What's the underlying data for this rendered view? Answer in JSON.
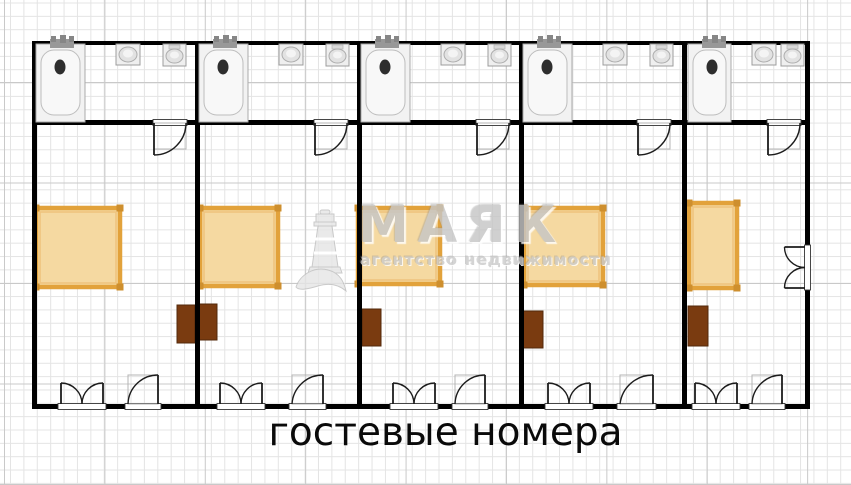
{
  "title": {
    "text": "гостевые номера"
  },
  "watermark": {
    "brand": "МАЯК",
    "tagline": "агентство недвижимости",
    "icon": "lighthouse-icon"
  },
  "colors": {
    "wall": "#000000",
    "door": "#1c1c1c",
    "door_frame": "#b5b5b5",
    "bed_fill": "#F5D9A1",
    "bed_border": "#E2A23B",
    "bed_inner": "#EFC27C",
    "bed_corner": "#CE8F2E",
    "nightstand_fill": "#7A3B10",
    "nightstand_stroke": "#53290B",
    "fixture_fill": "#efefef",
    "fixture_stroke": "#9c9c9c",
    "fixture_basin": "#e2e2e2",
    "tub_fill": "#f2f2f2",
    "faucet": "#989898",
    "drain": "#2e2e2e",
    "grid_minor": "#e4e4e4",
    "grid_major": "#c9c9c9",
    "watermark_gray": "#c6c6c6"
  },
  "plan": {
    "outline": {
      "x": 32,
      "y": 41,
      "w": 778,
      "h": 368,
      "wall_thickness": 5
    },
    "top_wall_y": 41,
    "divider_wall_y": 120,
    "bottom_wall_y": 404,
    "vertical_walls": [
      32,
      195,
      357,
      519,
      682,
      805
    ],
    "rooms": [
      {
        "name": "room-1",
        "tub_x": 36,
        "tub_w": 49,
        "sink_x": 116,
        "toilet_x": 163,
        "bath_door": [
          154,
          186
        ],
        "bed": {
          "x": 36,
          "y": 208,
          "w": 84,
          "h": 79
        },
        "nightstands": [
          {
            "x": 177,
            "y": 305,
            "w": 18,
            "h": 38
          }
        ],
        "double_door": [
          61,
          103
        ],
        "single_door": [
          128,
          158
        ]
      },
      {
        "name": "room-2",
        "tub_x": 199,
        "tub_w": 49,
        "sink_x": 279,
        "toilet_x": 326,
        "bath_door": [
          315,
          347
        ],
        "bed": {
          "x": 200,
          "y": 208,
          "w": 78,
          "h": 78
        },
        "nightstands": [
          {
            "x": 197,
            "y": 304,
            "w": 20,
            "h": 36
          }
        ],
        "double_door": [
          220,
          262
        ],
        "single_door": [
          292,
          323
        ]
      },
      {
        "name": "room-3",
        "tub_x": 361,
        "tub_w": 49,
        "sink_x": 441,
        "toilet_x": 488,
        "bath_door": [
          477,
          509
        ],
        "bed": {
          "x": 358,
          "y": 208,
          "w": 82,
          "h": 76
        },
        "nightstands": [
          {
            "x": 362,
            "y": 309,
            "w": 19,
            "h": 37
          }
        ],
        "double_door": [
          393,
          435
        ],
        "single_door": [
          455,
          485
        ]
      },
      {
        "name": "room-4",
        "tub_x": 523,
        "tub_w": 49,
        "sink_x": 603,
        "toilet_x": 650,
        "bath_door": [
          638,
          670
        ],
        "bed": {
          "x": 524,
          "y": 208,
          "w": 79,
          "h": 77
        },
        "nightstands": [
          {
            "x": 523,
            "y": 311,
            "w": 20,
            "h": 37
          }
        ],
        "double_door": [
          548,
          590
        ],
        "single_door": [
          620,
          653
        ]
      },
      {
        "name": "room-5",
        "tub_x": 688,
        "tub_w": 43,
        "sink_x": 752,
        "toilet_x": 781,
        "bath_door": [
          768,
          800
        ],
        "bed": {
          "x": 689,
          "y": 203,
          "w": 48,
          "h": 85
        },
        "nightstands": [
          {
            "x": 688,
            "y": 306,
            "w": 20,
            "h": 40
          }
        ],
        "double_door": [
          695,
          737
        ],
        "single_door": [
          752,
          782
        ],
        "side_door": [
          247,
          288
        ]
      }
    ]
  }
}
